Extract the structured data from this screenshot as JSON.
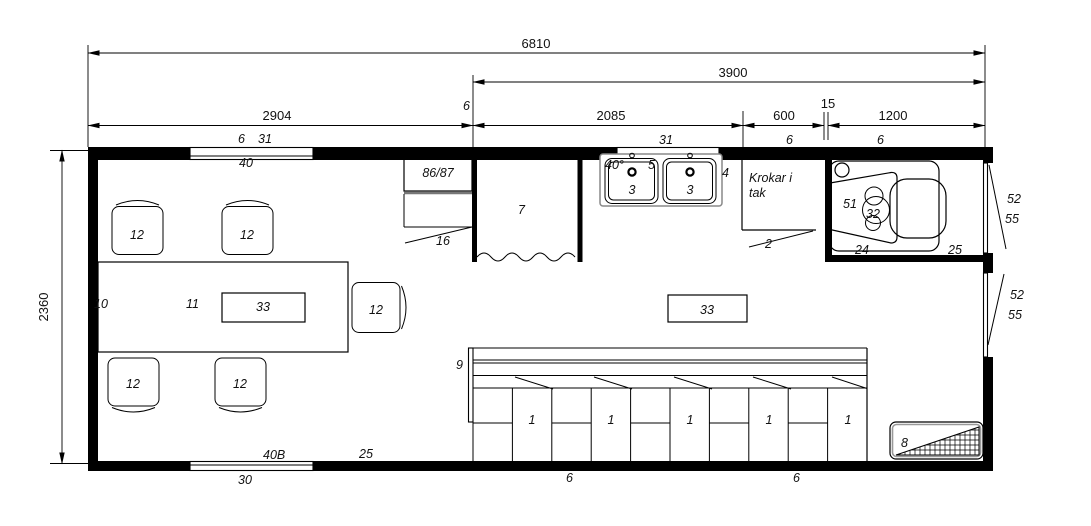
{
  "page": {
    "background": "#ffffff",
    "line_color": "#000000"
  },
  "dimensions": {
    "overall_width": "6810",
    "right_span": "3900",
    "left_span": "2904",
    "partition": "6",
    "mid_span": "2085",
    "hook_span": "600",
    "gap": "15",
    "wc_span": "1200",
    "depth": "2360"
  },
  "wall_labels": {
    "top_window_id": "6",
    "top_window_type": "31",
    "top_window_mark": "40",
    "sink_window_type": "31",
    "hook_wall_id": "6",
    "wc_wall_id": "6",
    "bottom_window_mark": "40B",
    "bottom_wall_mark": "25",
    "bottom_window_id": "30",
    "floor_joint_left": "6",
    "floor_joint_right": "6"
  },
  "items": {
    "floor": "10",
    "table": "11",
    "table_box": "33",
    "center_box": "33",
    "cabinet": "86/87",
    "counter": "16",
    "shower": "7",
    "water_temp": "40°",
    "tap": "5",
    "sink_left": "3",
    "sink_right": "3",
    "sink_bench": "4",
    "hooks_note_line1": "Krokar i",
    "hooks_note_line2": "tak",
    "hooks_leader": "2",
    "toilet_seat": "51",
    "toilet_bowl": "32",
    "wc_floor": "24",
    "wc_mark": "25",
    "bench": "9",
    "heater": "8",
    "door_upper_a": "52",
    "door_upper_b": "55",
    "door_lower_a": "52",
    "door_lower_b": "55"
  },
  "chairs": [
    "12",
    "12",
    "12",
    "12",
    "12"
  ],
  "lockers": [
    "1",
    "1",
    "1",
    "1",
    "1"
  ]
}
